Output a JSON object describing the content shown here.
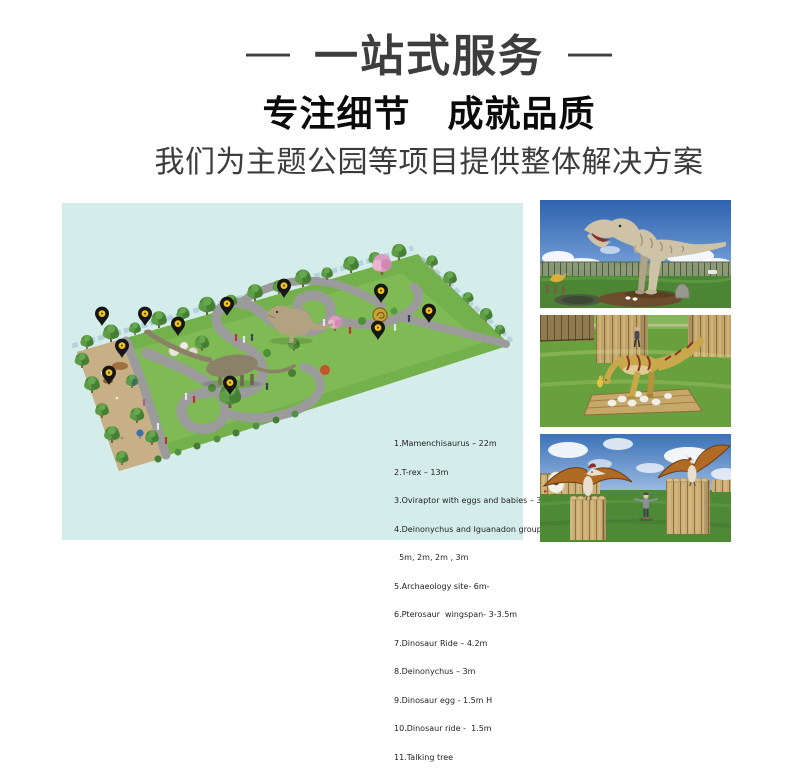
{
  "header": {
    "banner": {
      "dash_left": "—",
      "title": "一站式服务",
      "dash_right": "—"
    },
    "headline": "专注细节　成就品质",
    "subtitle": "我们为主题公园等项目提供整体解决方案"
  },
  "theme": {
    "map-bg": "#d4edeb",
    "title-color": "#3d3d3d",
    "headline-color": "#0a0a0a",
    "subtitle-color": "#3c3c3c",
    "pin-color": "#161616",
    "pin-dot-color": "#f0c419"
  },
  "park_map": {
    "legend": [
      "1.Mamenchisaurus – 22m",
      "2.T-rex – 13m",
      "3.Oviraptor with eggs and babies – 3m",
      "4.Deinonychus and Iguanadon group",
      "  5m, 2m, 2m , 3m",
      "5.Archaeology site- 6m-",
      "6.Pterosaur  wingspan- 3-3.5m",
      "7.Dinosaur Ride – 4.2m",
      "8.Deinonychus – 3m",
      "9.Dinosaur egg - 1.5m H",
      "10.Dinosaur ride -  1.5m",
      "11.Talking tree"
    ],
    "pin_count": 11
  }
}
